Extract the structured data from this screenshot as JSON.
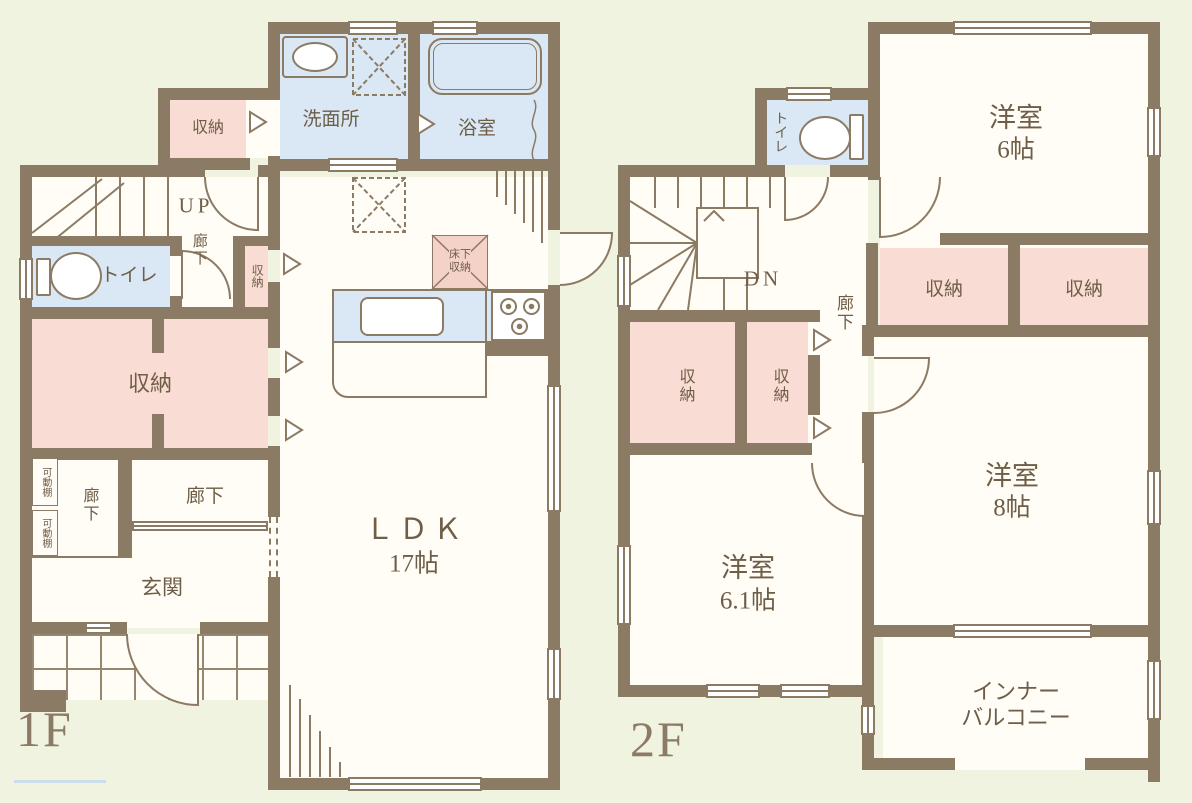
{
  "colors": {
    "background": "#f0f3df",
    "wall": "#8b7a64",
    "room_fill": "#fffdf6",
    "wet_area_fill": "#d9e8f4",
    "storage_fill": "#f9dcd4",
    "label_text": "#6e5d47",
    "floor_title": "#8b7a64"
  },
  "floor1": {
    "label": "1F",
    "rooms": {
      "washroom": "洗面所",
      "bathroom": "浴室",
      "storage_top": "収納",
      "stairs_up": "UP",
      "hall_upper": "廊下",
      "toilet": "トイレ",
      "storage_strip": "収納",
      "storage_main": "収納",
      "shelf_a": "可動棚",
      "shelf_b": "可動棚",
      "hall_side": "廊下",
      "hall": "廊下",
      "entrance": "玄関",
      "ldk_name": "ＬＤＫ",
      "ldk_size": "17帖",
      "underfloor_1": "床下",
      "underfloor_2": "収納"
    }
  },
  "floor2": {
    "label": "2F",
    "rooms": {
      "stairs_down": "DN",
      "toilet": "トイレ",
      "hall": "廊下",
      "room6_name": "洋室",
      "room6_size": "6帖",
      "storage_a": "収納",
      "storage_b": "収納",
      "storage_c": "収納",
      "storage_d": "収納",
      "room8_name": "洋室",
      "room8_size": "8帖",
      "room61_name": "洋室",
      "room61_size": "6.1帖",
      "balcony_1": "インナー",
      "balcony_2": "バルコニー"
    }
  }
}
